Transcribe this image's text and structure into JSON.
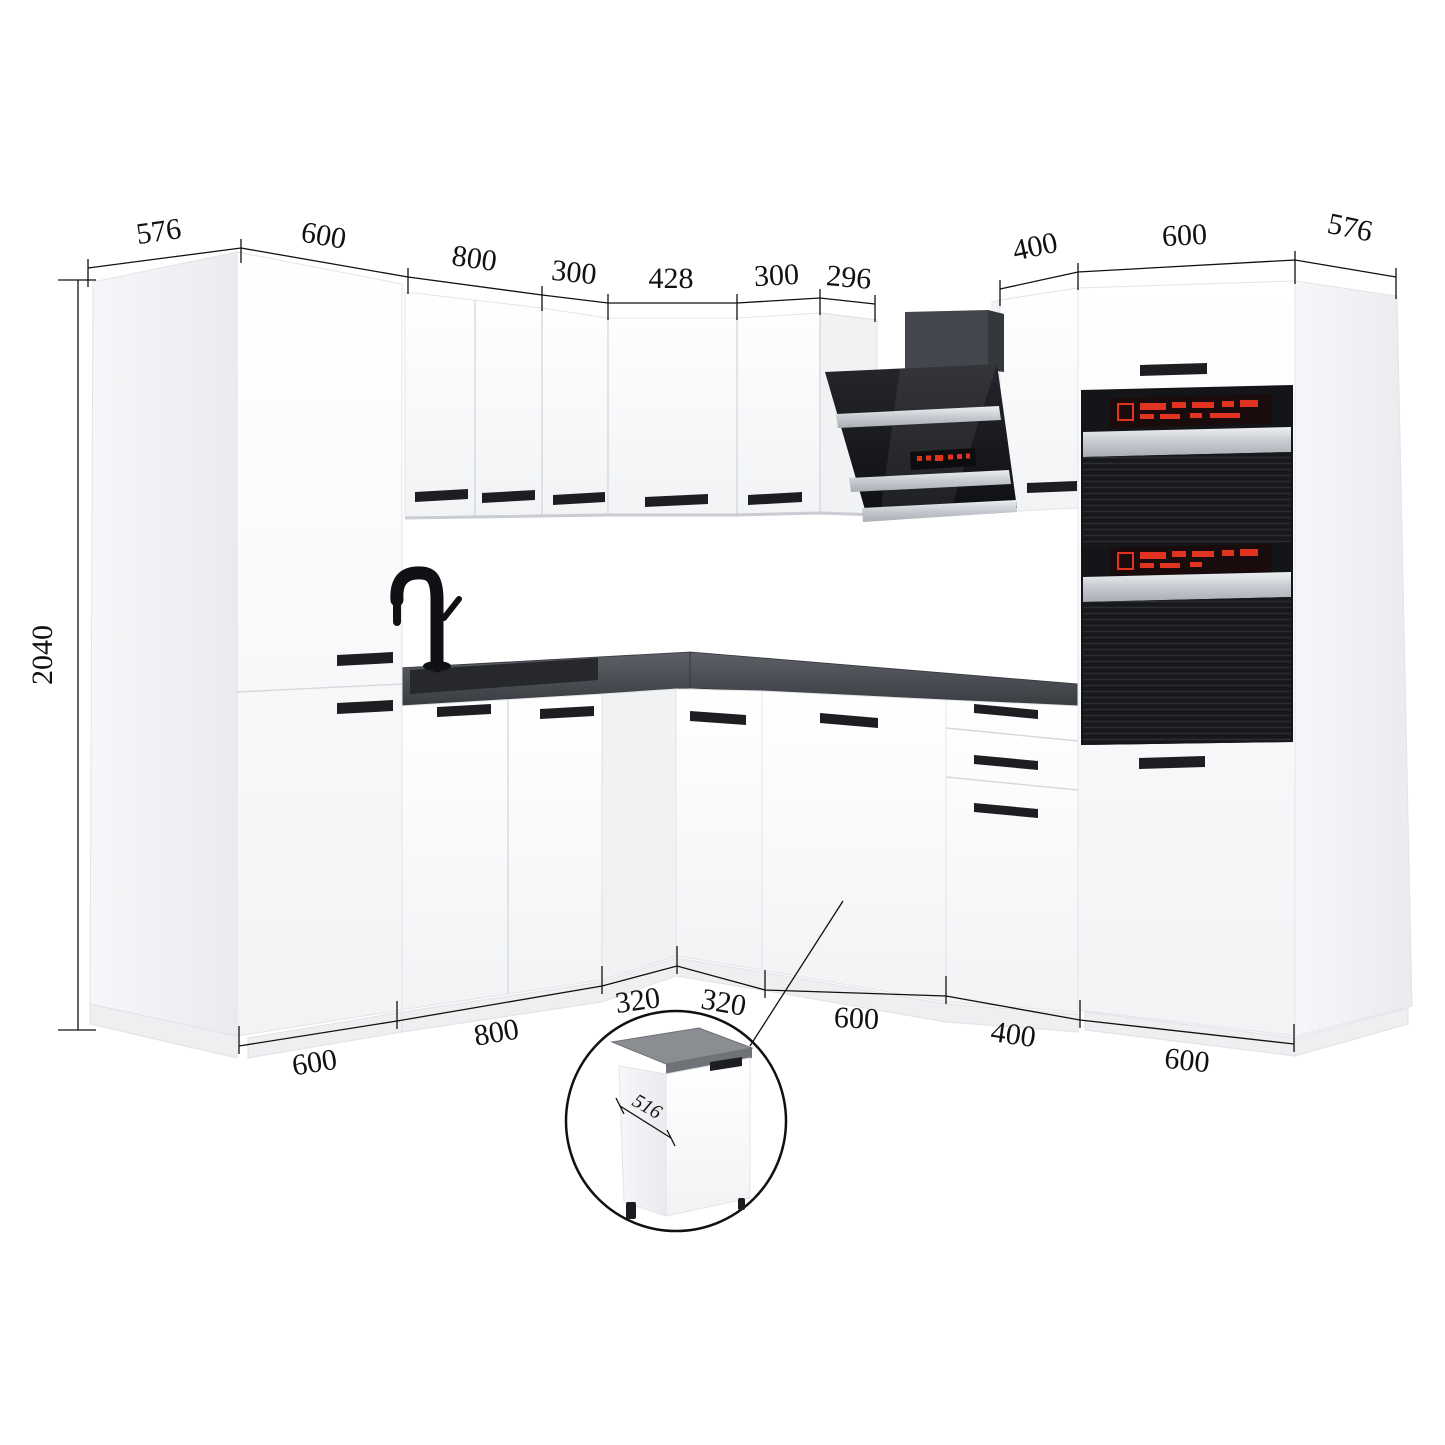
{
  "diagram": {
    "type": "kitchen-corner-cabinet-set-dimension-diagram",
    "unit_system": "mm",
    "scene": "L-shaped kitchen set, white fronts, black bar handles, dark grey worktop, black angled cooker hood, tall double-oven cabinet, inset detail circle of single base cabinet"
  },
  "dimensions": {
    "top_left": [
      "576",
      "600",
      "800",
      "300",
      "428",
      "300",
      "296"
    ],
    "top_right": [
      "400",
      "600",
      "576"
    ],
    "left_height": "2040",
    "bottom": [
      "600",
      "800",
      "320",
      "320",
      "600",
      "400",
      "600"
    ],
    "inset_cabinet_depth": "516"
  },
  "colors": {
    "line": "#111111",
    "cabinet_white": "#fafbfc",
    "cabinet_side": "#eef0f2",
    "countertop": "#4b4e54",
    "sink": "#26282c",
    "handle_black": "#1c1e22",
    "appliance_black": "#141518",
    "appliance_silver": "#cfd3d8",
    "display_red": "#e23220"
  }
}
